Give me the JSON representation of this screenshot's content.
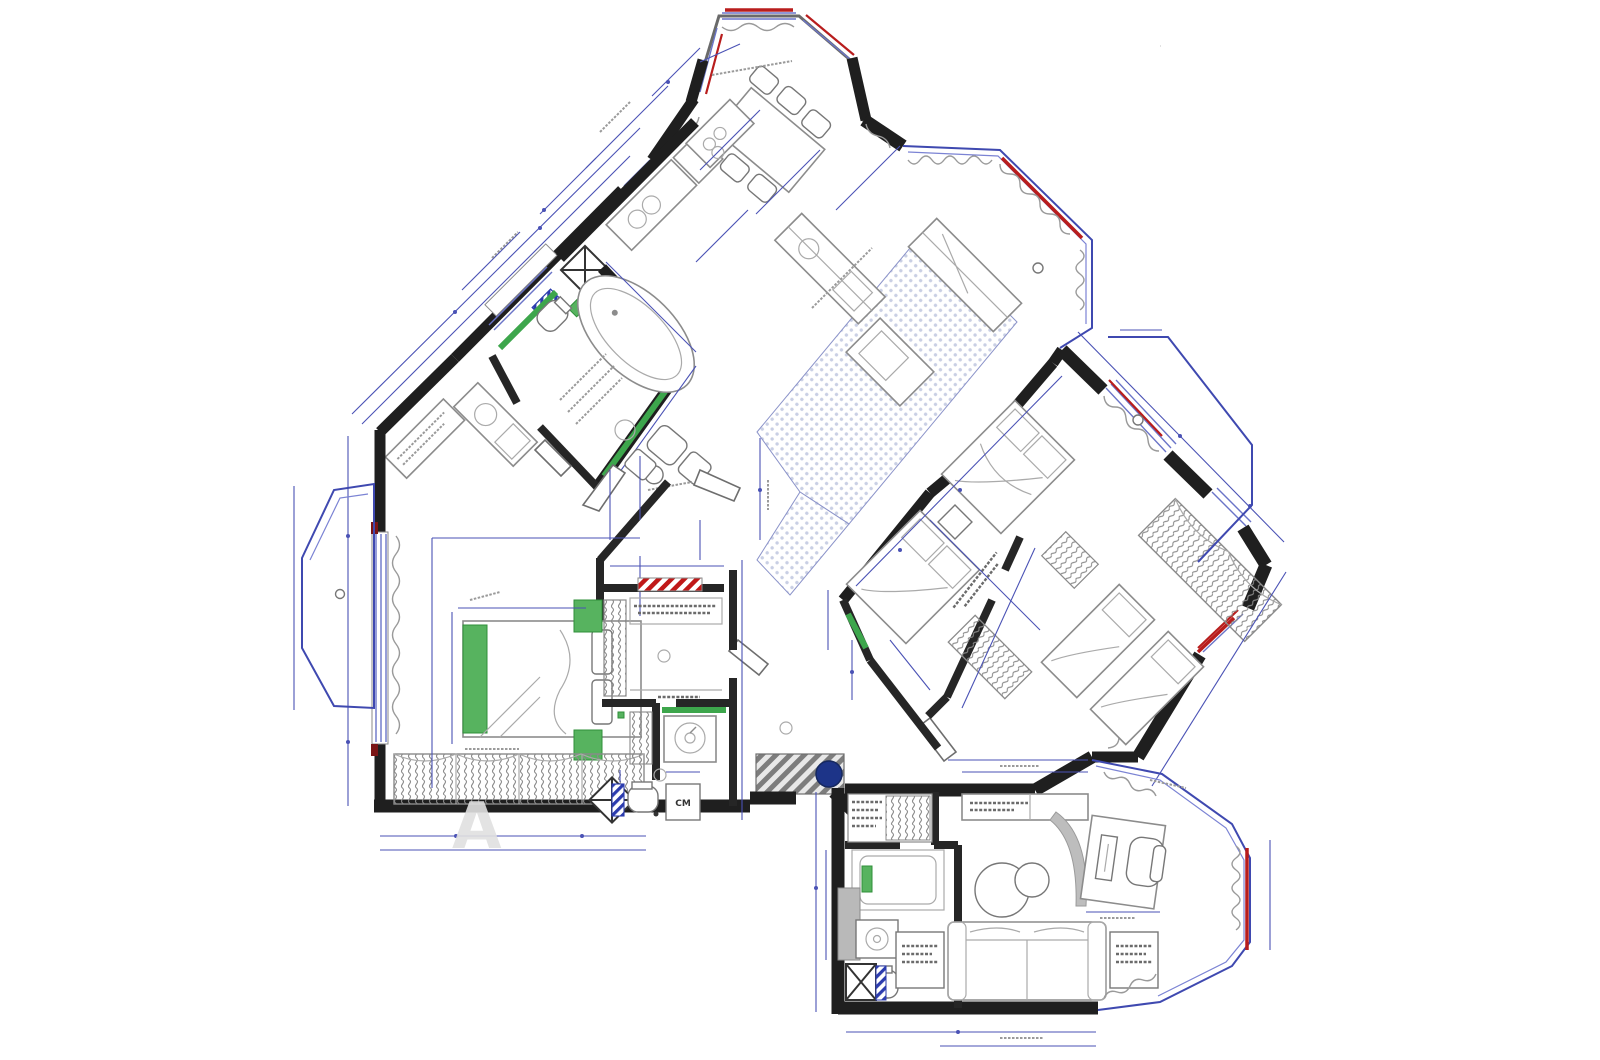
{
  "meta": {
    "type": "architectural-floor-plan",
    "description": "Apartment interior plan with three rotated wings, octagonal bay windows, furniture layout and dimension chains",
    "readable_text_note": "dimension numbers and room labels are illegible micro-text in the source image"
  },
  "labels": {
    "washing_machine": "СМ",
    "watermark_letter": "А"
  },
  "palette": {
    "wall": "#1f1f1f",
    "dimension_blue": "#4a52b5",
    "window_blue": "#6a74c8",
    "balcony_blue": "#3f49b0",
    "accent_red": "#b81d1d",
    "fixture_green": "#57b35f",
    "floor_hatch_dot": "#c9cfe4",
    "shaft_hatch_blue": "#2c3cae",
    "column_navy": "#1d3488",
    "mat_gray": "#8a8a8a",
    "furniture_gray": "#8c8c8c"
  },
  "rooms": [
    {
      "id": "dining-bay",
      "feature": "octagonal bay with table and six chairs"
    },
    {
      "id": "kitchen-corridor",
      "feature": "counter run with sink and hob"
    },
    {
      "id": "bathroom-upper",
      "feature": "oval tub, green tiled walls, shower shaft"
    },
    {
      "id": "living-kitchen",
      "feature": "dotted tile floor with island"
    },
    {
      "id": "terrace-top-right",
      "feature": "glazed curved balcony"
    },
    {
      "id": "bedroom-right-1",
      "feature": "double bed"
    },
    {
      "id": "bedroom-right-2",
      "feature": "double bed plus two single beds, coil wardrobes"
    },
    {
      "id": "balcony-right",
      "feature": "blue outlined balcony"
    },
    {
      "id": "master-bedroom",
      "feature": "green bed, long hanger wardrobe, left window, left balcony"
    },
    {
      "id": "wardrobe-room",
      "feature": "hanger rail and striped hatch strip"
    },
    {
      "id": "laundry-wc",
      "feature": "washing machine, toilet, ventilation shafts"
    },
    {
      "id": "entry",
      "feature": "striped mat and round structural column"
    },
    {
      "id": "study-living",
      "feature": "sofa, round tables, desk in octagonal bay"
    },
    {
      "id": "bathroom-lower",
      "feature": "shower, basin, toilet"
    }
  ]
}
